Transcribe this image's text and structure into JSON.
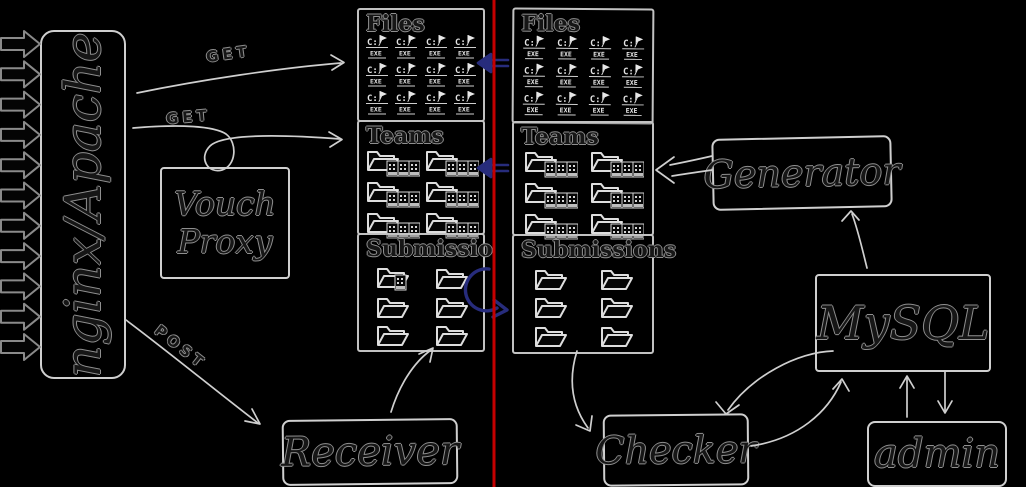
{
  "diagram": {
    "colors": {
      "background": "#000000",
      "stroke_light": "#cfcfcf",
      "accent_blue": "#272c7c",
      "divider_red": "#c40000"
    },
    "incoming_arrows_count": 11,
    "nodes": {
      "gateway": {
        "label": "nginx/Apache"
      },
      "vouch": {
        "label": "Vouch Proxy"
      },
      "receiver": {
        "label": "Receiver"
      },
      "generator": {
        "label": "Generator"
      },
      "mysql": {
        "label": "MySQL"
      },
      "checker": {
        "label": "Checker"
      },
      "admin": {
        "label": "admin"
      }
    },
    "edges": {
      "get_top_label": "GET",
      "get_mid_label": "GET",
      "post_label": "POST"
    },
    "exe_icon": {
      "line1": "C:/",
      "line2": "EXE"
    },
    "panels": {
      "left": {
        "files": {
          "title": "Files",
          "icon": "exe",
          "count": 12,
          "cols": 4
        },
        "teams": {
          "title": "Teams",
          "icon": "team",
          "count": 6,
          "cols": 2
        },
        "submissions": {
          "title": "Submissio",
          "icon": "folder",
          "count": 6,
          "cols": 2,
          "first_has_file": true
        }
      },
      "right": {
        "files": {
          "title": "Files",
          "icon": "exe",
          "count": 12,
          "cols": 4
        },
        "teams": {
          "title": "Teams",
          "icon": "team",
          "count": 6,
          "cols": 2
        },
        "submissions": {
          "title": "Submissions",
          "icon": "folder",
          "count": 6,
          "cols": 2
        }
      }
    }
  }
}
